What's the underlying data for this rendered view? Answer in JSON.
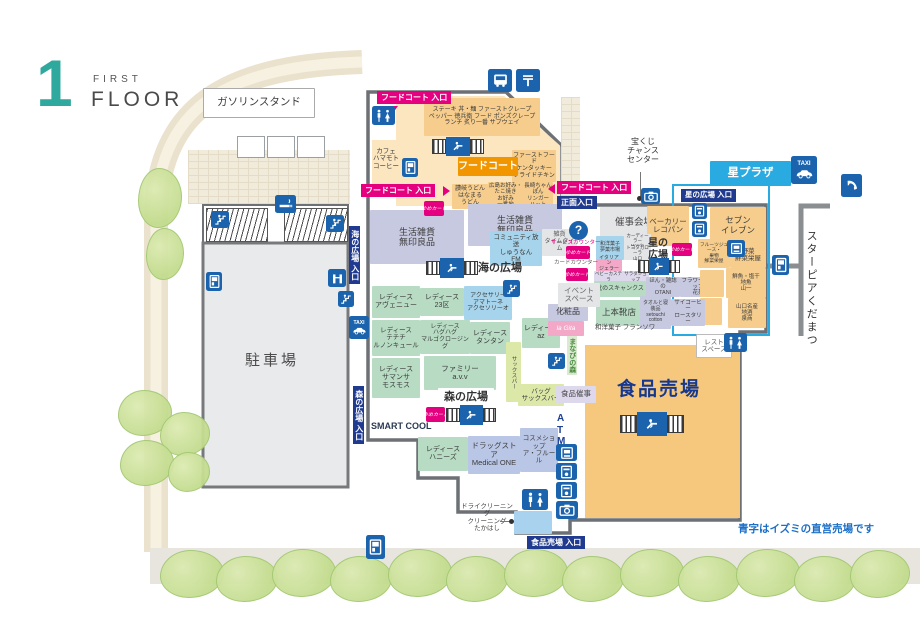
{
  "header": {
    "floor_number": "1",
    "floor_label_top": "FIRST",
    "floor_label_bottom": "FLOOR"
  },
  "notice": "青字はイズミの直営売場です",
  "plazas": {
    "sea": "海の広場",
    "forest": "森の広場",
    "star": "星の\n広場",
    "hoshi_plaza": "星プラザ",
    "starpia": "スターピアくだまつ"
  },
  "areas": {
    "gas_station": "ガソリンスタンド",
    "parking": "駐車場",
    "food_hall": "食品売場",
    "food_court": "フードコート",
    "event_hall": "催事会場",
    "event_space": "イベント\nスペース",
    "rest_space": "レスト\nスペース",
    "smart_cool": "SMART COOL",
    "lottery": "宝くじ\nチャンス\nセンター",
    "food_event": "食品催事",
    "atm": "A\nT\nM",
    "manabinomori": "まなびの森"
  },
  "entrances": {
    "food_court": "フードコート 入口",
    "main": "正面入口",
    "sea": "海の広場 入口",
    "forest": "森の広場 入口",
    "star": "星の広場 入口",
    "food": "食品売場 入口"
  },
  "counters": {
    "service": "サービスカウンター",
    "card": "カードカウンター",
    "yume_card": "ゆめカード"
  },
  "icons": {
    "info": "?",
    "post": "〒",
    "taxi": "TAXI"
  },
  "shops": {
    "fc_tenants": "ステーキ 丼・麺 ファーストクレープ\nペッパー 徳兵衛 フード ポンズクレープ\nランチ 炙り一番 サブウェイ",
    "kfc": "ファーストフード\nケンタッキー\nフライドチキン",
    "hanamaru": "讃岐うどん\nはなまる\nうどん",
    "okonomi": "広島お好み・たこ焼き\nお好み\n一番地",
    "ringer": "長崎ちゃんぽん\nリンガー\nハット",
    "cafe_hamamoto": "カフェ\nハマモト\nコーヒー",
    "muji": "生活雑貨\n無印良品",
    "shunan_fm": "コミュニティ放送\nしゅうなん\nFM",
    "time_time": "雑貨\nタイムタイム",
    "ladies_avenue": "レディース\nアヴェニュー",
    "ladies_23ku": "レディース\n23区",
    "amatone": "アクセサリー\nアマトーネ\nアクセソリーオ",
    "techichi": "レディース\nテチチ\nルノンキュール",
    "hughug": "レディース\nハグハグ\nマルゴクロージング",
    "tamtam": "レディース\nタンタン",
    "avv": "ファミリー\na.v.v",
    "az": "レディース\naz",
    "cosmetics": "化粧品",
    "cosme_brand": "la Gita",
    "samansa": "レディース\nサマンサ\nモスモス",
    "honeys": "レディース\nハニーズ",
    "medical_one": "ドラッグストア\nMedical ONE",
    "afleur": "コスメショップ\nア・フルール",
    "sax_bar_v": "サックスバー",
    "sax_bar": "バッグ\nサックスバー",
    "takahashi": "ドライクリーニング\nクリーニング\nたかはし",
    "lecopain": "ベーカリー\nレコパン",
    "seven_eleven": "セブン\nイレブン",
    "sensai_fruit": "フルーツジュース・\n果物\n鮮菜栄屋",
    "sensai_veg": "野菜\n鮮菜栄屋",
    "yamaichi": "鮮魚・塩干\n地魚\n山一",
    "izumisho": "山口名産\n地酒\n泉商",
    "otani": "ほん・雑誌の\nOTANI",
    "hanazono": "フラワーショップ\n花苑",
    "uemoto": "上本靴店",
    "francois": "和洋菓子 フランソワ",
    "setouchi_cotton": "タオルと寝装品\nsetouchi\ncotton",
    "sai_coffee": "サイコーヒー\nロースタリー",
    "wagashi": "和洋菓子\n夢菓市場",
    "dealer_honda": "カーディーラー\nHonda",
    "dealer_toyota": "トヨタカローラ\n山口",
    "gelato": "イタリアン\nジェラート",
    "castella": "ベビーカステラ",
    "salad": "サラダショップ",
    "scankusu": "靴のスキャンクス"
  }
}
